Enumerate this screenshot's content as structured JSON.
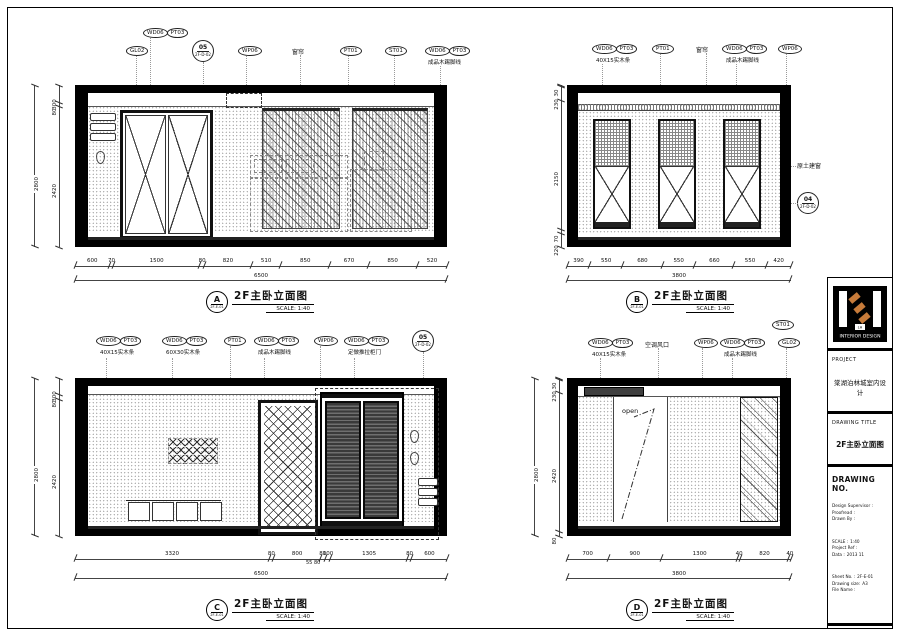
{
  "colors": {
    "accent_orange": "#c77b3a",
    "line": "#1a1a1a"
  },
  "title_block": {
    "logo_text": "INTERIOR DESIGN",
    "logo_mark": "LH",
    "project_label": "PROJECT",
    "project_name": "棠湖泊林城室内设计",
    "drawing_title_label": "DRAWING TITLE",
    "drawing_title": "2F主卧立面图",
    "drawing_no_label": "DRAWING NO.",
    "fields_people": [
      {
        "label": "Design Supervisor :",
        "value": ""
      },
      {
        "label": "Proofread :",
        "value": ""
      },
      {
        "label": "Drawn By :",
        "value": ""
      }
    ],
    "fields_meta": [
      {
        "label": "SCALE :",
        "value": "1:40"
      },
      {
        "label": "Project Ref :",
        "value": ""
      },
      {
        "label": "Data :",
        "value": "2013 11"
      }
    ],
    "fields_file": [
      {
        "label": "Sheet No. :",
        "value": "2F-E-01"
      },
      {
        "label": "Drawing size:",
        "value": "A3"
      },
      {
        "label": "File Name :",
        "value": ""
      }
    ]
  },
  "elevA": {
    "key": "A",
    "key_ref": "2F-E-01",
    "title": "2F主卧立面图",
    "scale": "SCALE: 1:40",
    "callouts": {
      "wd1": "WD06",
      "pt1": "PT03",
      "gl": "GL02",
      "d_num": "05",
      "d_ref": "2F-D-02",
      "wp": "WP06",
      "curtain": "窗帘",
      "pt": "PT01",
      "st": "ST01",
      "wd2": "WD06",
      "pt2": "PT03",
      "sub2": "成品木踢脚线"
    },
    "dims_h": [
      600,
      70,
      1500,
      80,
      820,
      510,
      850,
      670,
      850,
      520
    ],
    "total_h": "6500",
    "dims_v": [
      300,
      80,
      2420
    ],
    "total_v": "2800"
  },
  "elevB": {
    "key": "B",
    "key_ref": "2F-E-01",
    "title": "2F主卧立面图",
    "scale": "SCALE: 1:40",
    "callouts": {
      "wd1": "WD06",
      "pt1": "PT03",
      "sub1": "40X15实木条",
      "pt": "PT01",
      "curtain": "窗帘",
      "wd2": "WD06",
      "pt2": "PT03",
      "sub2": "成品木踢脚线",
      "wp": "WP06",
      "window_note": "原土建窗",
      "d_num": "04",
      "d_ref": "2F-D-02"
    },
    "dims_h": [
      390,
      550,
      680,
      550,
      660,
      550,
      420
    ],
    "total_h": "3800",
    "dims_v": [
      30,
      230,
      2150,
      70,
      220
    ]
  },
  "elevC": {
    "key": "C",
    "key_ref": "2F-E-01",
    "title": "2F主卧立面图",
    "scale": "SCALE: 1:40",
    "callouts": {
      "wd1": "WD06",
      "pt1": "PT03",
      "sub1": "40X15实木条",
      "wd2": "WD06",
      "pt2": "PT03",
      "sub2": "60X30实木条",
      "pt": "PT01",
      "wd3": "WD06",
      "pt3": "PT03",
      "sub3": "成品木踢脚线",
      "wp": "WP06",
      "wd4": "WD06",
      "pt4": "PT03",
      "sub4": "定做推拉柜门",
      "d_num": "05",
      "d_ref": "2F-D-02"
    },
    "dims_h": [
      3320,
      80,
      800,
      80,
      100,
      1305,
      80,
      600
    ],
    "sub_dims": "55 80",
    "total_h": "6500",
    "dims_v": [
      300,
      80,
      2420
    ],
    "total_v": "2800"
  },
  "elevD": {
    "key": "D",
    "key_ref": "2F-E-01",
    "title": "2F主卧立面图",
    "scale": "SCALE: 1:40",
    "callouts": {
      "st": "ST01",
      "wd1": "WD06",
      "pt1": "PT03",
      "sub1": "40X15实木条",
      "ac": "空调风口",
      "wp": "WP06",
      "wd2": "WD06",
      "pt2": "PT03",
      "sub2": "成品木踢脚线",
      "gl": "GL02",
      "open": "open"
    },
    "dims_h": [
      700,
      900,
      1300,
      40,
      820,
      40
    ],
    "total_h": "3800",
    "dims_v": [
      30,
      230,
      2420,
      80
    ],
    "total_v": "2800"
  }
}
